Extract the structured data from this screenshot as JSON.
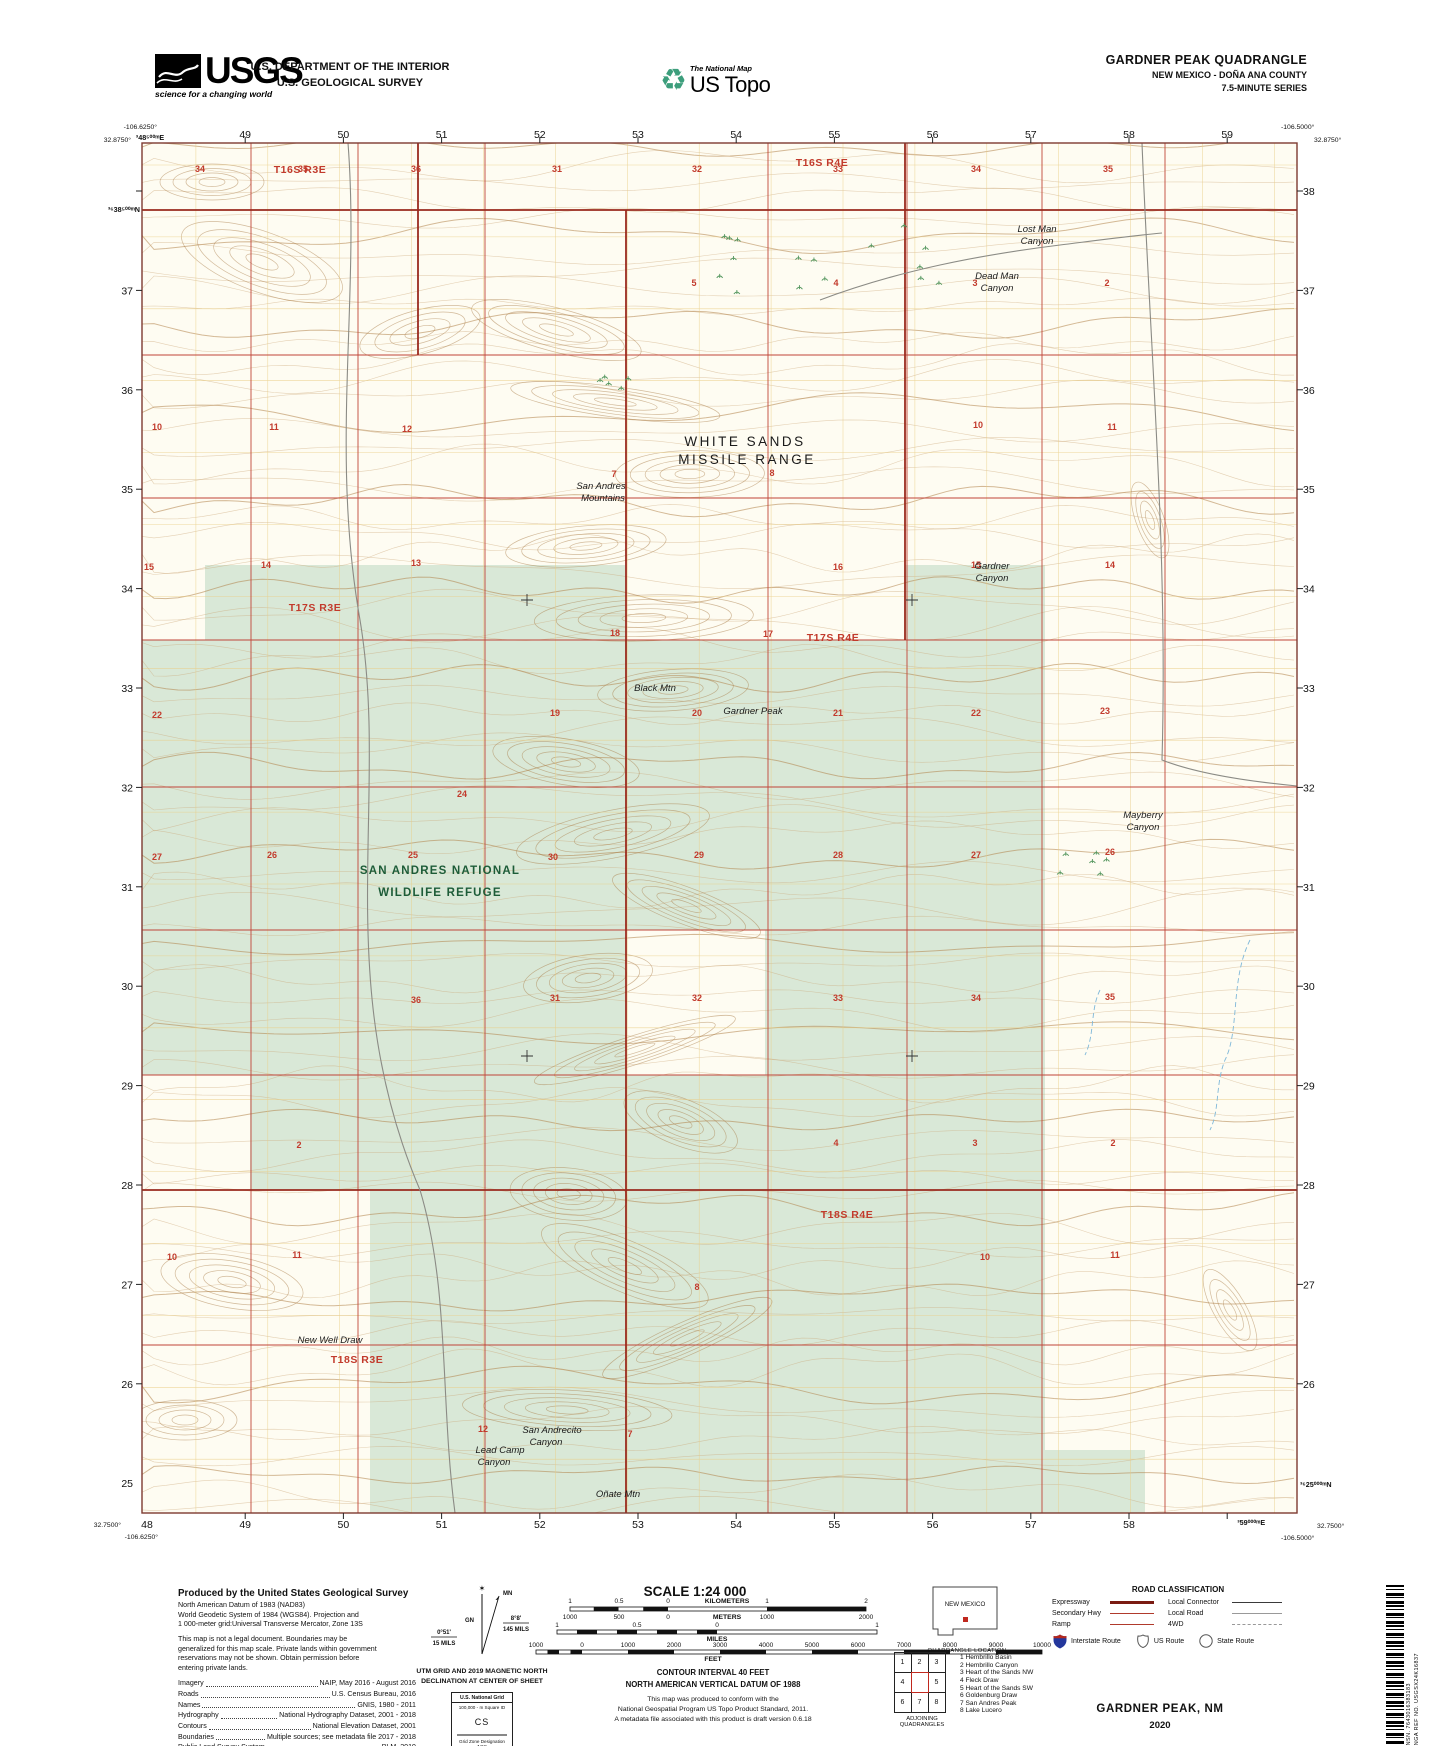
{
  "colors": {
    "section_red": "#c23a2c",
    "township_red": "#9a2a1e",
    "green_tint": "#d9e8d7",
    "contour_brown": "#cba676",
    "refuge_green": "#1d5c38",
    "water_blue": "#7fb8d9",
    "interstate_blue": "#24379c"
  },
  "header": {
    "usgs": {
      "acronym": "USGS",
      "tagline": "science for a changing world"
    },
    "department": {
      "line1": "U.S. DEPARTMENT OF THE INTERIOR",
      "line2": "U.S. GEOLOGICAL SURVEY"
    },
    "national_map": {
      "line1": "The National Map",
      "line2": "US Topo"
    },
    "quadrangle": {
      "title": "GARDNER PEAK QUADRANGLE",
      "subtitle": "NEW MEXICO - DOÑA ANA COUNTY",
      "series": "7.5-MINUTE SERIES"
    }
  },
  "map": {
    "corners": {
      "top_left": [
        "-106.6250°",
        "32.8750°"
      ],
      "top_right": [
        "-106.5000°",
        "32.8750°"
      ],
      "bottom_left": [
        "32.7500°",
        "-106.6250°"
      ],
      "bottom_right": [
        "32.7500°",
        "-106.5000°"
      ]
    },
    "utm_labels": {
      "top_first": "³48⁵⁰⁰ᵐE",
      "left_first": "³⁶38⁵⁰⁰ᵐN",
      "bottom_last": "³59⁰⁰⁰ᵐE",
      "right_last": "³⁶25⁰⁰⁰ᵐN"
    },
    "top_numbers": [
      "49",
      "50",
      "51",
      "52",
      "53",
      "54",
      "55",
      "56",
      "57",
      "58",
      "59"
    ],
    "bottom_numbers": [
      "48",
      "49",
      "50",
      "51",
      "52",
      "53",
      "54",
      "55",
      "56",
      "57",
      "58"
    ],
    "left_numbers": [
      "37",
      "36",
      "35",
      "34",
      "33",
      "32",
      "31",
      "30",
      "29",
      "28",
      "27",
      "26",
      "25"
    ],
    "right_numbers": [
      "38",
      "37",
      "36",
      "35",
      "34",
      "33",
      "32",
      "31",
      "30",
      "29",
      "28",
      "27",
      "26"
    ],
    "township_labels": [
      [
        "T16S R3E",
        300,
        173
      ],
      [
        "T16S R4E",
        822,
        166
      ],
      [
        "T17S R3E",
        315,
        611
      ],
      [
        "T17S R4E",
        833,
        641
      ],
      [
        "T18S R3E",
        357,
        1363
      ],
      [
        "T18S R4E",
        847,
        1218
      ]
    ],
    "section_numbers": [
      [
        "34",
        200,
        172
      ],
      [
        "35",
        303,
        172
      ],
      [
        "36",
        416,
        172
      ],
      [
        "31",
        557,
        172
      ],
      [
        "32",
        697,
        172
      ],
      [
        "33",
        838,
        172
      ],
      [
        "34",
        976,
        172
      ],
      [
        "35",
        1108,
        172
      ],
      [
        "5",
        694,
        286
      ],
      [
        "4",
        836,
        286
      ],
      [
        "3",
        975,
        286
      ],
      [
        "2",
        1107,
        286
      ],
      [
        "10",
        157,
        430
      ],
      [
        "11",
        274,
        430
      ],
      [
        "12",
        407,
        432
      ],
      [
        "7",
        614,
        477
      ],
      [
        "8",
        772,
        476
      ],
      [
        "10",
        978,
        428
      ],
      [
        "11",
        1112,
        430
      ],
      [
        "15",
        149,
        570
      ],
      [
        "14",
        266,
        568
      ],
      [
        "13",
        416,
        566
      ],
      [
        "18",
        615,
        636
      ],
      [
        "17",
        768,
        637
      ],
      [
        "16",
        838,
        570
      ],
      [
        "15",
        976,
        568
      ],
      [
        "14",
        1110,
        568
      ],
      [
        "22",
        157,
        718
      ],
      [
        "24",
        462,
        797
      ],
      [
        "19",
        555,
        716
      ],
      [
        "20",
        697,
        716
      ],
      [
        "21",
        838,
        716
      ],
      [
        "22",
        976,
        716
      ],
      [
        "23",
        1105,
        714
      ],
      [
        "27",
        157,
        860
      ],
      [
        "26",
        272,
        858
      ],
      [
        "25",
        413,
        858
      ],
      [
        "30",
        553,
        860
      ],
      [
        "29",
        699,
        858
      ],
      [
        "28",
        838,
        858
      ],
      [
        "27",
        976,
        858
      ],
      [
        "26",
        1110,
        855
      ],
      [
        "36",
        416,
        1003
      ],
      [
        "31",
        555,
        1001
      ],
      [
        "32",
        697,
        1001
      ],
      [
        "33",
        838,
        1001
      ],
      [
        "34",
        976,
        1001
      ],
      [
        "35",
        1110,
        1000
      ],
      [
        "2",
        299,
        1148
      ],
      [
        "4",
        836,
        1146
      ],
      [
        "3",
        975,
        1146
      ],
      [
        "2",
        1113,
        1146
      ],
      [
        "10",
        172,
        1260
      ],
      [
        "11",
        297,
        1258
      ],
      [
        "12",
        483,
        1432
      ],
      [
        "7",
        630,
        1437
      ],
      [
        "8",
        697,
        1290
      ],
      [
        "10",
        985,
        1260
      ],
      [
        "11",
        1115,
        1258
      ]
    ],
    "place_labels": [
      {
        "t": "Lost Man",
        "x": 1037,
        "y": 232,
        "c": "feat"
      },
      {
        "t": "Canyon",
        "x": 1037,
        "y": 244,
        "c": "feat"
      },
      {
        "t": "Dead Man",
        "x": 997,
        "y": 279,
        "c": "feat"
      },
      {
        "t": "Canyon",
        "x": 997,
        "y": 291,
        "c": "feat"
      },
      {
        "t": "WHITE SANDS",
        "x": 745,
        "y": 446,
        "c": "admin"
      },
      {
        "t": "MISSILE RANGE",
        "x": 747,
        "y": 464,
        "c": "admin"
      },
      {
        "t": "San Andres",
        "x": 601,
        "y": 489,
        "c": "feat"
      },
      {
        "t": "Mountains",
        "x": 603,
        "y": 501,
        "c": "feat"
      },
      {
        "t": "Gardner",
        "x": 992,
        "y": 569,
        "c": "feat"
      },
      {
        "t": "Canyon",
        "x": 992,
        "y": 581,
        "c": "feat"
      },
      {
        "t": "Gardner Peak",
        "x": 753,
        "y": 714,
        "c": "peak"
      },
      {
        "t": "Black Mtn",
        "x": 655,
        "y": 691,
        "c": "peak"
      },
      {
        "t": "SAN ANDRES NATIONAL",
        "x": 440,
        "y": 874,
        "c": "refuge"
      },
      {
        "t": "WILDLIFE REFUGE",
        "x": 440,
        "y": 896,
        "c": "refuge"
      },
      {
        "t": "Mayberry",
        "x": 1143,
        "y": 818,
        "c": "feat"
      },
      {
        "t": "Canyon",
        "x": 1143,
        "y": 830,
        "c": "feat"
      },
      {
        "t": "New Well Draw",
        "x": 330,
        "y": 1343,
        "c": "feat"
      },
      {
        "t": "San Andrecito",
        "x": 552,
        "y": 1433,
        "c": "feat"
      },
      {
        "t": "Canyon",
        "x": 546,
        "y": 1445,
        "c": "feat"
      },
      {
        "t": "Lead Camp",
        "x": 500,
        "y": 1453,
        "c": "feat"
      },
      {
        "t": "Canyon",
        "x": 494,
        "y": 1465,
        "c": "feat"
      },
      {
        "t": "Oñate Mtn",
        "x": 618,
        "y": 1497,
        "c": "peak"
      }
    ]
  },
  "footer": {
    "produced": {
      "title": "Produced by the United States Geological Survey",
      "datum_lines": [
        "North American Datum of 1983 (NAD83)",
        "World Geodetic System of 1984 (WGS84).  Projection and",
        "1 000-meter grid:Universal Transverse Mercator, Zone 13S"
      ],
      "legal_lines": [
        "This map is not a legal document. Boundaries may be",
        "generalized for this map scale. Private lands within government",
        "reservations may not be shown. Obtain permission before",
        "entering private lands."
      ],
      "credits": [
        [
          "Imagery",
          "NAIP, May 2016 - August 2016"
        ],
        [
          "Roads",
          "U.S. Census Bureau, 2016"
        ],
        [
          "Names",
          "GNIS, 1980 - 2011"
        ],
        [
          "Hydrography",
          "National Hydrography Dataset, 2001 - 2018"
        ],
        [
          "Contours",
          "National Elevation Dataset, 2001"
        ],
        [
          "Boundaries",
          "Multiple sources; see metadata file 2017 - 2018"
        ],
        [
          "Public Land Survey System",
          "BLM, 2019"
        ],
        [
          "Wetlands",
          "FWS National Wetlands Inventory 1971 - 1976"
        ]
      ]
    },
    "declination": {
      "gn": "GN",
      "mn": "MN",
      "east_deg": "8°8'",
      "east_mils": "145 MILS",
      "west_deg": "0°51'",
      "west_mils": "15 MILS",
      "caption1": "UTM GRID AND 2019 MAGNETIC NORTH",
      "caption2": "DECLINATION AT CENTER OF SHEET"
    },
    "usng": {
      "title": "U.S. National Grid",
      "sq": "100,000 - m Square ID",
      "square": "CS",
      "zone_label": "Grid Zone Designation",
      "zone": "13S"
    },
    "scale": {
      "title": "SCALE 1:24 000",
      "bars": {
        "km": [
          "1",
          "0.5",
          "0",
          "1",
          "2"
        ],
        "km_unit": "KILOMETERS",
        "m": [
          "1000",
          "500",
          "0",
          "1000",
          "2000"
        ],
        "m_unit": "METERS",
        "mi": [
          "1",
          "0.5",
          "0",
          "1"
        ],
        "mi_unit": "MILES",
        "ft": [
          "1000",
          "0",
          "1000",
          "2000",
          "3000",
          "4000",
          "5000",
          "6000",
          "7000",
          "8000",
          "9000",
          "10000"
        ],
        "ft_unit": "FEET"
      },
      "contour1": "CONTOUR INTERVAL 40 FEET",
      "contour2": "NORTH AMERICAN VERTICAL DATUM OF 1988",
      "conform": [
        "This map was produced to conform with the",
        "National Geospatial Program US Topo Product Standard, 2011.",
        "A metadata file associated with this product is draft version 0.6.18"
      ]
    },
    "location": {
      "state": "NEW MEXICO",
      "caption": "QUADRANGLE LOCATION"
    },
    "adjoining": {
      "cells": [
        "1",
        "2",
        "3",
        "4",
        "",
        "5",
        "6",
        "7",
        "8"
      ],
      "names": [
        "1 Hembrillo Basin",
        "2 Hembrillo Canyon",
        "3 Heart of the Sands NW",
        "4 Fleck Draw",
        "5 Heart of the Sands SW",
        "6 Goldenburg Draw",
        "7 San Andres Peak",
        "8 Lake Lucero"
      ],
      "caption": "ADJOINING QUADRANGLES"
    },
    "roads": {
      "title": "ROAD CLASSIFICATION",
      "expressway": "Expressway",
      "secondary": "Secondary Hwy",
      "ramp": "Ramp",
      "connector": "Local Connector",
      "local": "Local Road",
      "fourwd": "4WD",
      "interstate": "Interstate Route",
      "us": "US Route",
      "state": "State Route"
    },
    "sheet": {
      "name": "GARDNER PEAK,  NM",
      "year": "2020"
    },
    "barcode": {
      "nsn": "NSN. 7643016383183",
      "nga": "NGA REF NO. USGSX24K16837"
    }
  }
}
